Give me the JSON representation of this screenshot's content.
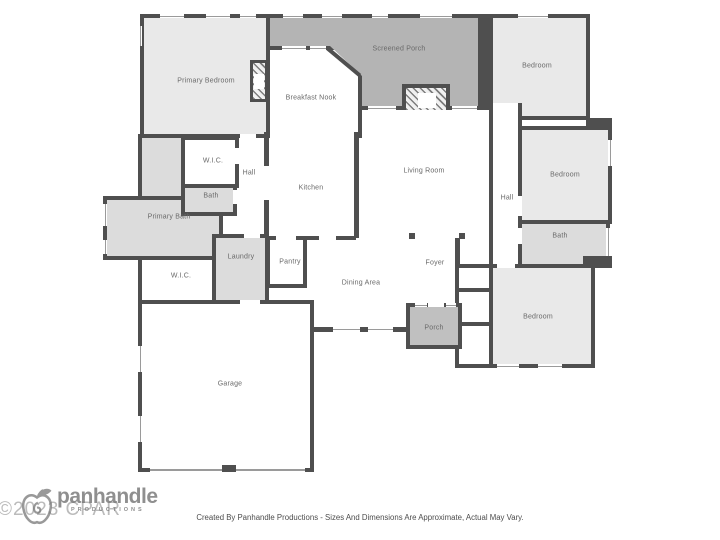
{
  "floorplan": {
    "rooms": [
      {
        "id": "primary-bedroom",
        "label": "Primary Bedroom"
      },
      {
        "id": "breakfast-nook",
        "label": "Breakfast Nook"
      },
      {
        "id": "screened-porch",
        "label": "Screened Porch"
      },
      {
        "id": "bedroom-top-right",
        "label": "Bedroom"
      },
      {
        "id": "wic-upper",
        "label": "W.I.C."
      },
      {
        "id": "hall-left",
        "label": "Hall"
      },
      {
        "id": "bath-upper",
        "label": "Bath"
      },
      {
        "id": "primary-bath",
        "label": "Primary Bath"
      },
      {
        "id": "kitchen",
        "label": "Kitchen"
      },
      {
        "id": "living-room",
        "label": "Living Room"
      },
      {
        "id": "hall-right",
        "label": "Hall"
      },
      {
        "id": "bedroom-right",
        "label": "Bedroom"
      },
      {
        "id": "bath-right",
        "label": "Bath"
      },
      {
        "id": "laundry",
        "label": "Laundry"
      },
      {
        "id": "pantry",
        "label": "Pantry"
      },
      {
        "id": "dining-area",
        "label": "Dining Area"
      },
      {
        "id": "foyer",
        "label": "Foyer"
      },
      {
        "id": "wic-lower",
        "label": "W.I.C."
      },
      {
        "id": "porch",
        "label": "Porch"
      },
      {
        "id": "bedroom-bottom-right",
        "label": "Bedroom"
      },
      {
        "id": "garage",
        "label": "Garage"
      }
    ],
    "colors": {
      "wall": "#4f4f4f",
      "bedroom_fill": "#e9e9e9",
      "bath_fill": "#dcdcdc",
      "screened_porch_fill": "#b4b4b4",
      "porch_fill": "#c0c0c0",
      "label_text": "#696969"
    }
  },
  "watermark": {
    "text": "©2023 CPAR"
  },
  "logo": {
    "icon": "apple-icon",
    "name": "panhandle",
    "subtitle": "PRODUCTIONS"
  },
  "footer": {
    "text": "Created By Panhandle Productions - Sizes And Dimensions Are Approximate, Actual May Vary."
  }
}
